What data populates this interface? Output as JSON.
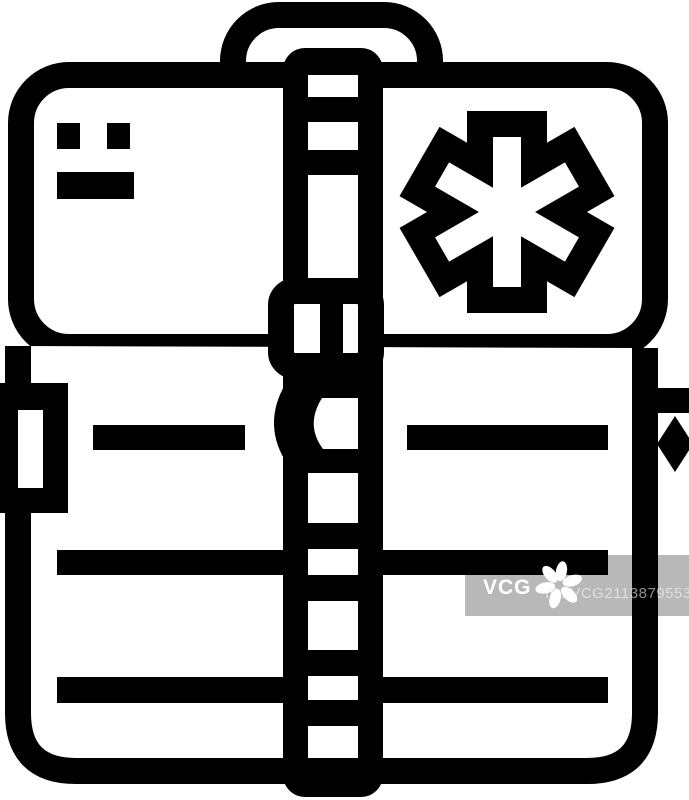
{
  "image": {
    "title": "Medical first aid bag line icon",
    "type": "stock line icon",
    "background_color": "#ffffff",
    "line_color": "#000000",
    "fill_color": "#ffffff",
    "parts": [
      "handle",
      "front-flap",
      "flap-label-marks",
      "star-of-life-emblem",
      "bag-body",
      "pocket-stripes",
      "center-zipper-strap",
      "strap-buckle",
      "left-side-buckle",
      "right-side-clasp"
    ]
  },
  "watermark": {
    "logo_text": "VCG",
    "id_text": "ID: VCG211387955315",
    "band_color": "rgba(0,0,0,0.28)",
    "logo_color": "#ffffff",
    "id_text_color": "rgba(255,255,255,0.55)"
  }
}
